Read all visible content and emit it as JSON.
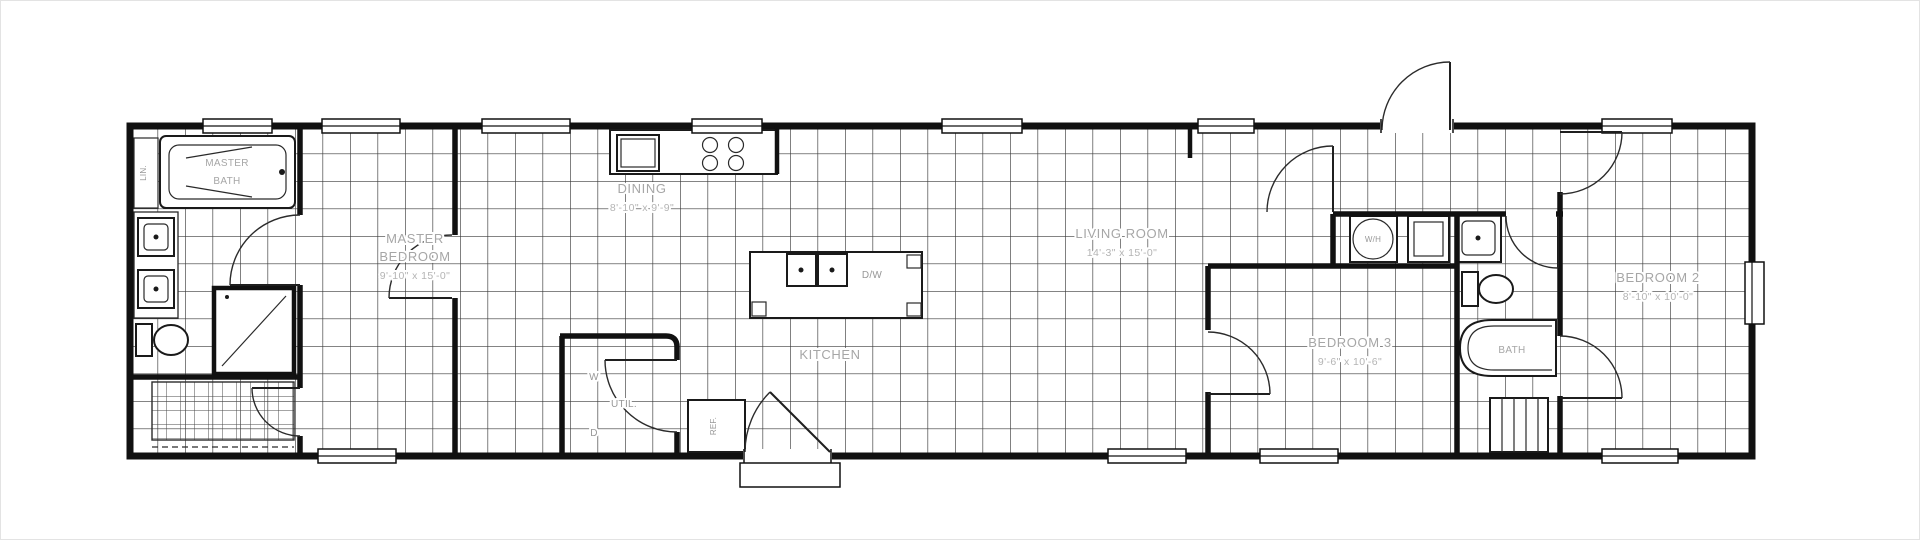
{
  "colors": {
    "background": "#ffffff",
    "walls": "#111111",
    "grid_lines": "#3a3a3a",
    "room_label": "#a6a6a6",
    "dimension_label": "#b4b4b4",
    "fixture_label": "#979797"
  },
  "rooms": {
    "master_bath": {
      "line1": "MASTER",
      "line2": "BATH"
    },
    "master_bedroom": {
      "line1": "MASTER",
      "line2": "BEDROOM",
      "dims": "9'-10\" x 15'-0\""
    },
    "dining": {
      "name": "DINING",
      "dims": "8'-10\" x 9'-9\""
    },
    "kitchen": {
      "name": "KITCHEN"
    },
    "living_room": {
      "name": "LIVING ROOM",
      "dims": "14'-3\" x 15'-0\""
    },
    "bedroom_3": {
      "name": "BEDROOM 3",
      "dims": "9'-6\" x 10'-6\""
    },
    "bath": {
      "name": "BATH"
    },
    "bedroom_2": {
      "name": "BEDROOM 2",
      "dims": "8'-10\" x 10'-0\""
    },
    "utility": {
      "name": "UTIL.",
      "washer": "W",
      "dryer": "D"
    }
  },
  "fixtures": {
    "dishwasher": "D/W",
    "water_heater": "W/H",
    "refrigerator": "REF.",
    "linen": "LIN."
  }
}
